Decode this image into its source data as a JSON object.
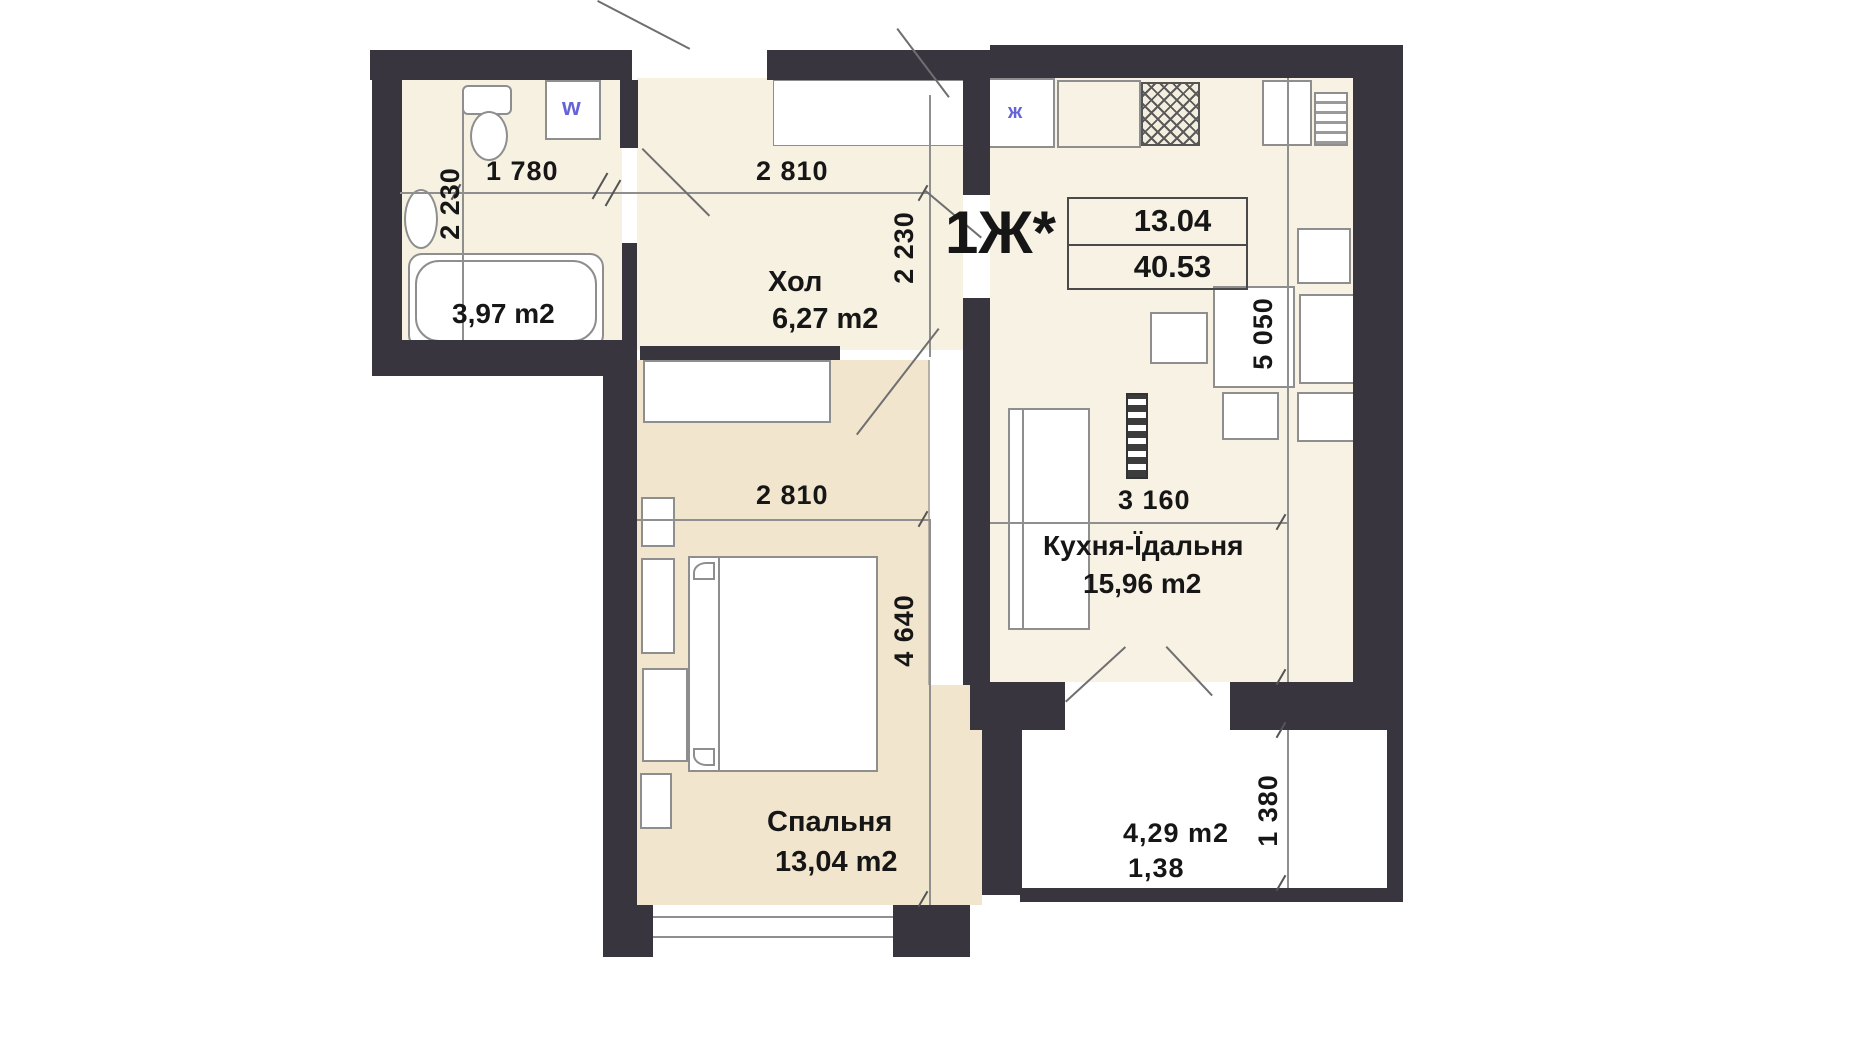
{
  "unit": {
    "label": "1Ж*",
    "stamp": {
      "room_area": "13.04",
      "total_area": "40.53"
    }
  },
  "rooms": {
    "bathroom": {
      "area": "3,97 m2"
    },
    "hall": {
      "name": "Хол",
      "area": "6,27 m2"
    },
    "kitchen": {
      "name": "Кухня-Їдальня",
      "area": "15,96 m2"
    },
    "bedroom": {
      "name": "Спальня",
      "area": "13,04 m2"
    },
    "balcony": {
      "area": "4,29 m2",
      "coefficient": "1,38"
    }
  },
  "dimensions": {
    "bathroom_width": "1 780",
    "bathroom_depth": "2 230",
    "hall_width": "2 810",
    "hall_depth": "2 230",
    "bedroom_width": "2 810",
    "bedroom_depth": "4 640",
    "kitchen_width": "3 160",
    "kitchen_depth": "5 050",
    "balcony_depth": "1 380"
  },
  "icons": {
    "washer": "w",
    "kitchen_sink": "ж"
  },
  "colors": {
    "wall": "#38353f",
    "room_fill": "#f7f1e2",
    "bedroom_fill": "#f1e5cd",
    "accent_blue": "#6464d8"
  }
}
